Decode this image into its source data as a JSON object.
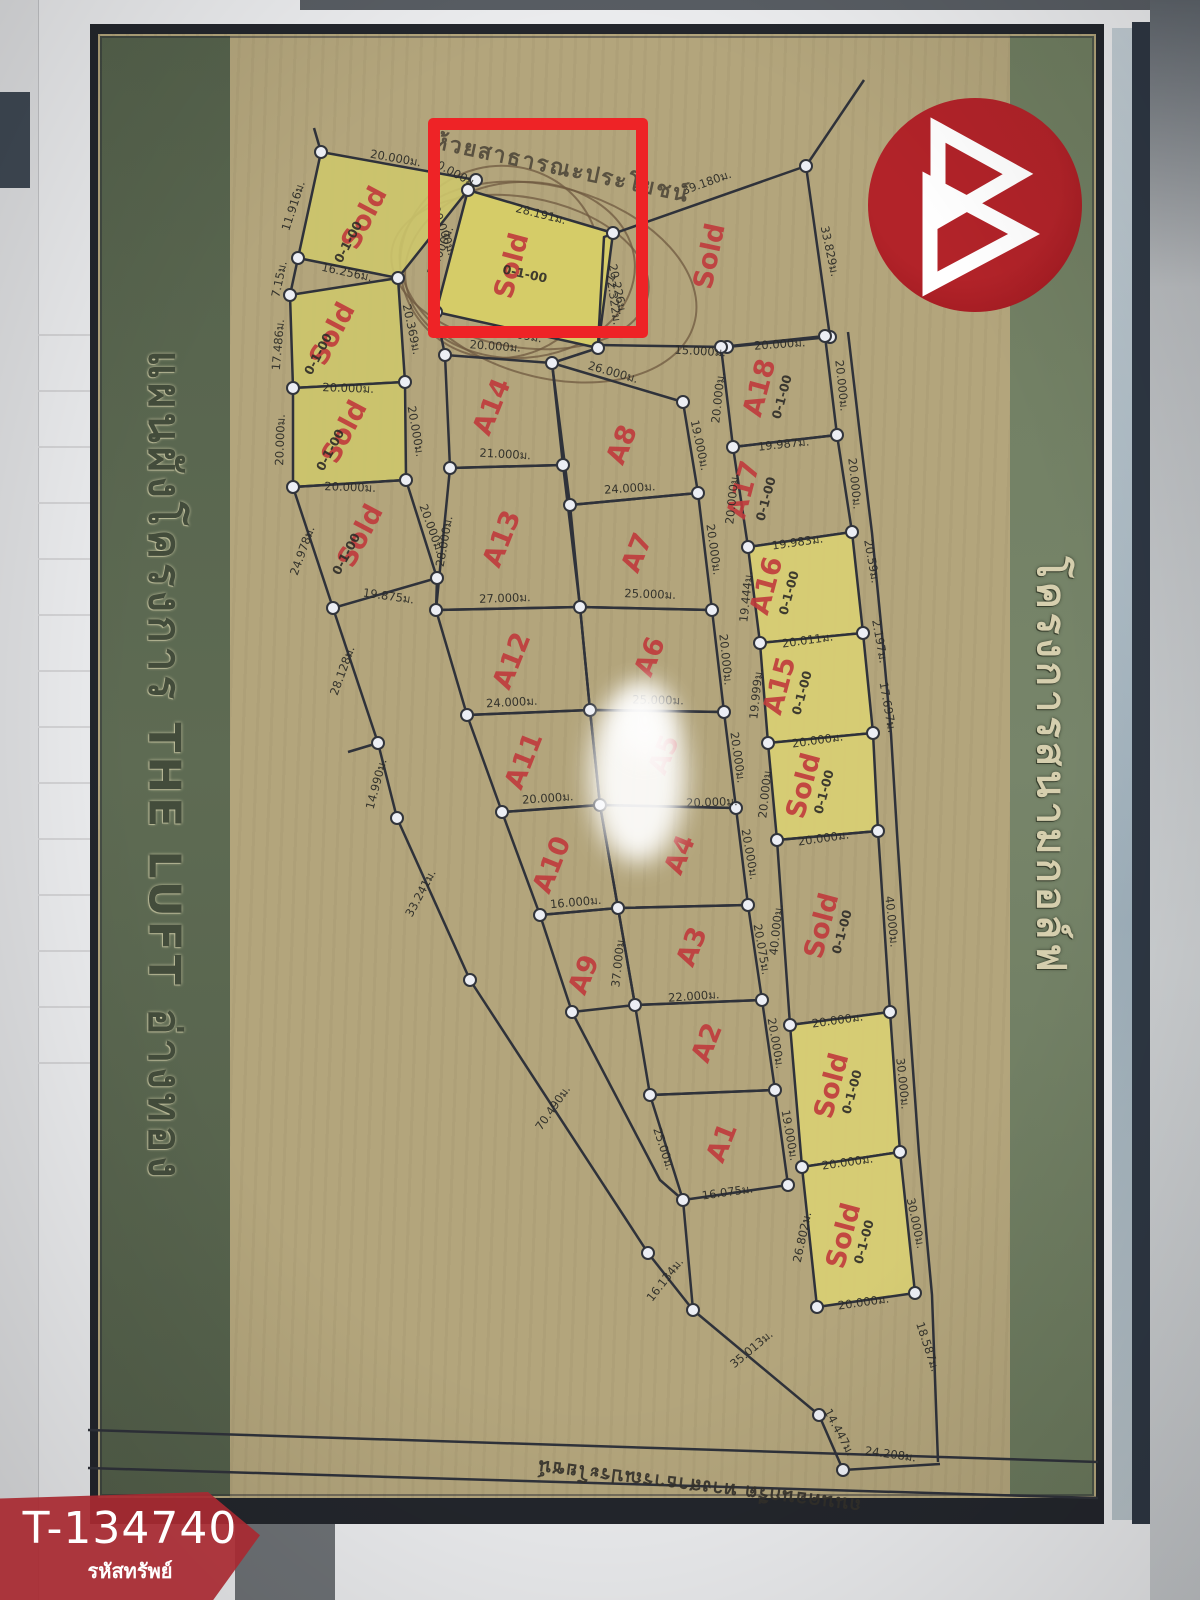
{
  "badge": {
    "code": "T-134740",
    "label": "รหัสทรัพย์"
  },
  "map": {
    "left_band": "แผนผังโครงการ THE LUFT อ่างทอง",
    "right_band": "โครงการสนามกอล์ฟ",
    "top_label": "ห้วยสาธารณะประโยชน์",
    "bottom_road_label": "ถนนคอนกรีต ทางสาธารณประโยชน์",
    "colors": {
      "highlight_red": "#ee2326",
      "logo_red": "#9e1b22",
      "banner_red": "#ae3138",
      "plot_yellow": "#d8ce74",
      "label_red": "#c03a3c",
      "band_green": "#5c6a50"
    },
    "plots": [
      {
        "label": "Sold",
        "area": "0-1-00"
      },
      {
        "label": "Sold",
        "area": "0-1-00"
      },
      {
        "label": "Sold",
        "area": "0-1-00"
      },
      {
        "label": "Sold",
        "area": "0-1-00"
      },
      {
        "label": "Sold",
        "area": "0-1-00"
      },
      {
        "label": "Sold"
      },
      {
        "label": "A18",
        "area": "0-1-00"
      },
      {
        "label": "A17",
        "area": "0-1-00"
      },
      {
        "label": "A16",
        "area": "0-1-00"
      },
      {
        "label": "A15",
        "area": "0-1-00"
      },
      {
        "label": "Sold",
        "area": "0-1-00"
      },
      {
        "label": "Sold",
        "area": "0-1-00"
      },
      {
        "label": "Sold",
        "area": "0-1-00"
      },
      {
        "label": "Sold",
        "area": "0-1-00"
      },
      {
        "label": "A14"
      },
      {
        "label": "A13"
      },
      {
        "label": "A12"
      },
      {
        "label": "A11"
      },
      {
        "label": "A10"
      },
      {
        "label": "A9"
      },
      {
        "label": "A8"
      },
      {
        "label": "A7"
      },
      {
        "label": "A6"
      },
      {
        "label": "A5"
      },
      {
        "label": "A4"
      },
      {
        "label": "A3"
      },
      {
        "label": "A2"
      },
      {
        "label": "A1"
      }
    ],
    "dims": [
      "20.000ม.",
      "11.916ม.",
      "20.000ม.",
      "16.256ม.",
      "7.15ม.",
      "17.486ม.",
      "20.369ม.",
      "20.000ม.",
      "20.000ม.",
      "20.000ม.",
      "20.000ม.",
      "24.978ม.",
      "20.000ม.",
      "19.875ม.",
      "20.000ม.",
      "28.191ม.",
      "20.000ม.",
      "20.226ม.",
      "31.809ม.",
      "39.180ม.",
      "33.829ม.",
      "22.322ม.",
      "15.000ม.",
      "20.000ม.",
      "20.000ม.",
      "20.000ม.",
      "19.987ม.",
      "20.000ม.",
      "20.000ม.",
      "19.983ม.",
      "19.444ม.",
      "20.011ม.",
      "19.999ม.",
      "20.000ม.",
      "20.000ม.",
      "20.000ม.",
      "40.000ม.",
      "40.000ม.",
      "20.000ม.",
      "30.000ม.",
      "20.000ม.",
      "26.802ม.",
      "30.000ม.",
      "20.000ม.",
      "20.59ม.",
      "2.197ม.",
      "17.697ม.",
      "18.587ม.",
      "14.447ม.",
      "24.208ม.",
      "28.128ม.",
      "14.990ม.",
      "33.241ม.",
      "70.490ม.",
      "16.134ม.",
      "35.013ม.",
      "20.000ม.",
      "26.000ม.",
      "21.000ม.",
      "19.000ม.",
      "24.000ม.",
      "28.000ม.",
      "27.000ม.",
      "25.000ม.",
      "20.000ม.",
      "24.000ม.",
      "25.000ม.",
      "20.000ม.",
      "20.000ม.",
      "20.000ม.",
      "20.000ม.",
      "16.000ม.",
      "37.000ม.",
      "20.075ม.",
      "20.000ม.",
      "22.000ม.",
      "19.000ม.",
      "16.075ม.",
      "25.00ม.",
      "20.000ม."
    ]
  }
}
